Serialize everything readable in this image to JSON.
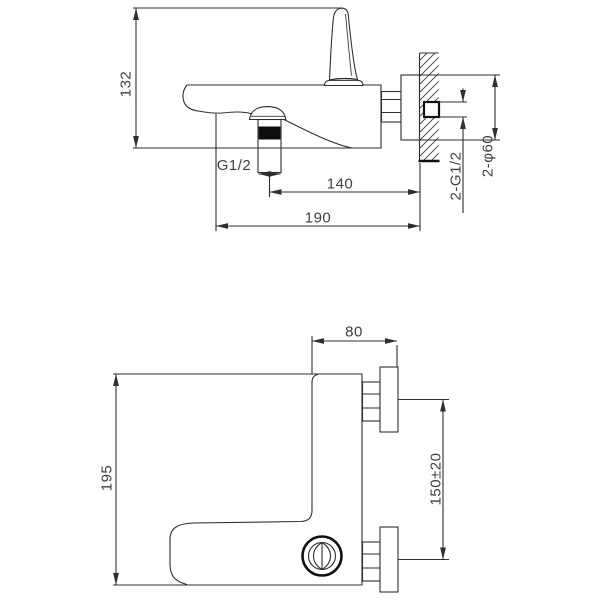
{
  "drawing": {
    "background": "#ffffff",
    "line_color": "#2f2f2f",
    "side_view": {
      "dims": {
        "overall_height": "132",
        "outlet_thread": "G1/2",
        "outlet_center_to_wall": "140",
        "overall_depth": "190",
        "inlet_thread": "2-G1/2",
        "escutcheon_diameter": "2-φ60"
      }
    },
    "plan_view": {
      "dims": {
        "wall_to_body": "80",
        "body_width": "195",
        "inlet_spacing": "150±20"
      }
    }
  }
}
